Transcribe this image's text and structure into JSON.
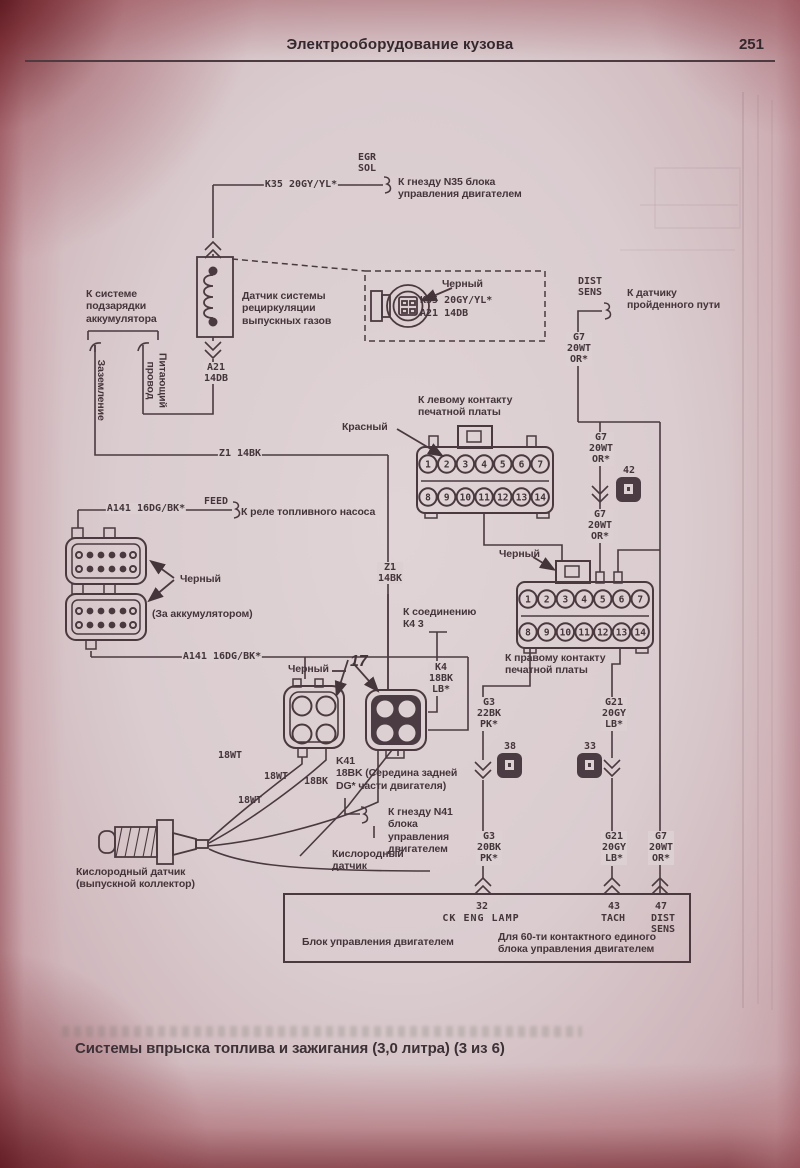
{
  "header": {
    "title": "Электрооборудование кузова",
    "page_number": "251"
  },
  "caption": "Системы впрыска топлива и зажигания (3,0 литра) (3 из 6)",
  "colors": {
    "paper": "#dcd0d2",
    "ink": "#44353b",
    "edge_red": "#7a2a30"
  },
  "connector_pins": {
    "top": [
      "1",
      "2",
      "3",
      "4",
      "5",
      "6",
      "7"
    ],
    "bottom": [
      "8",
      "9",
      "10",
      "11",
      "12",
      "13",
      "14"
    ]
  },
  "labels": {
    "egr_sol": "EGR\nSOL",
    "k35_wire": "K35 20GY/YL*",
    "to_n35": "К гнезду N35 блока\nуправления двигателем",
    "to_charge": "К системе\nподзарядки\nаккумулятора",
    "egr_sensor": "Датчик системы\nрециркуляции\nвыпускных газов",
    "ground_v": "Заземление",
    "feed_v": "Питающий провод",
    "a21": "A21\n14DB",
    "black1": "Черный",
    "k35_b": "K35 20GY/YL*",
    "a21_b": "A21 14DB",
    "dist_sens_top": "DIST\nSENS",
    "to_dist": "К датчику\nпройденного пути",
    "g7_1": "G7\n20WT\nOR*",
    "to_left_contact": "К левому контакту\nпечатной платы",
    "red": "Красный",
    "g7_2": "G7\n20WT\nOR*",
    "n42": "42",
    "g7_3": "G7\n20WT\nOR*",
    "z1_h": "Z1 14BK",
    "a141_1": "A141 16DG/BK*",
    "feed": "FEED",
    "to_fuel_relay": "К реле топливного насоса",
    "black2": "Черный",
    "behind_batt": "(За аккумулятором)",
    "a141_2": "A141 16DG/BK*",
    "z1_v": "Z1\n14BK",
    "black3": "Черный",
    "n17": "17",
    "to_k4": "К соединению\nК4 3",
    "k4": "K4\n18BK\nLB*",
    "black4": "Черный",
    "to_right_contact": "К правому контакту\nпечатной платы",
    "g3_1": "G3\n22BK\nPK*",
    "n38": "38",
    "n33": "33",
    "g21_1": "G21\n20GY\nLB*",
    "wt18_1": "18WT",
    "wt18_2": "18WT",
    "wt18_3": "18WT",
    "bk18": "18BK",
    "k41": "K41\n18BK (Середина задней\nDG*  части двигателя)",
    "to_n41": "К гнезду N41\nблока\nуправления\nдвигателем",
    "o2_left": "Кислородный датчик\n(выпускной коллектор)",
    "o2_right": "Кислородный\nдатчик",
    "g3_2": "G3\n20BK\nPK*",
    "g21_2": "G21\n20GY\nLB*",
    "g7_4": "G7\n20WT\nOR*"
  },
  "ecm": {
    "pin32": "32",
    "pin32_name": "CK ENG LAMP",
    "pin43": "43",
    "pin43_name": "TACH",
    "pin47": "47",
    "pin47_name": "DIST\nSENS",
    "name": "Блок управления двигателем",
    "note": "Для 60-ти контактного единого\nблока управления двигателем"
  }
}
